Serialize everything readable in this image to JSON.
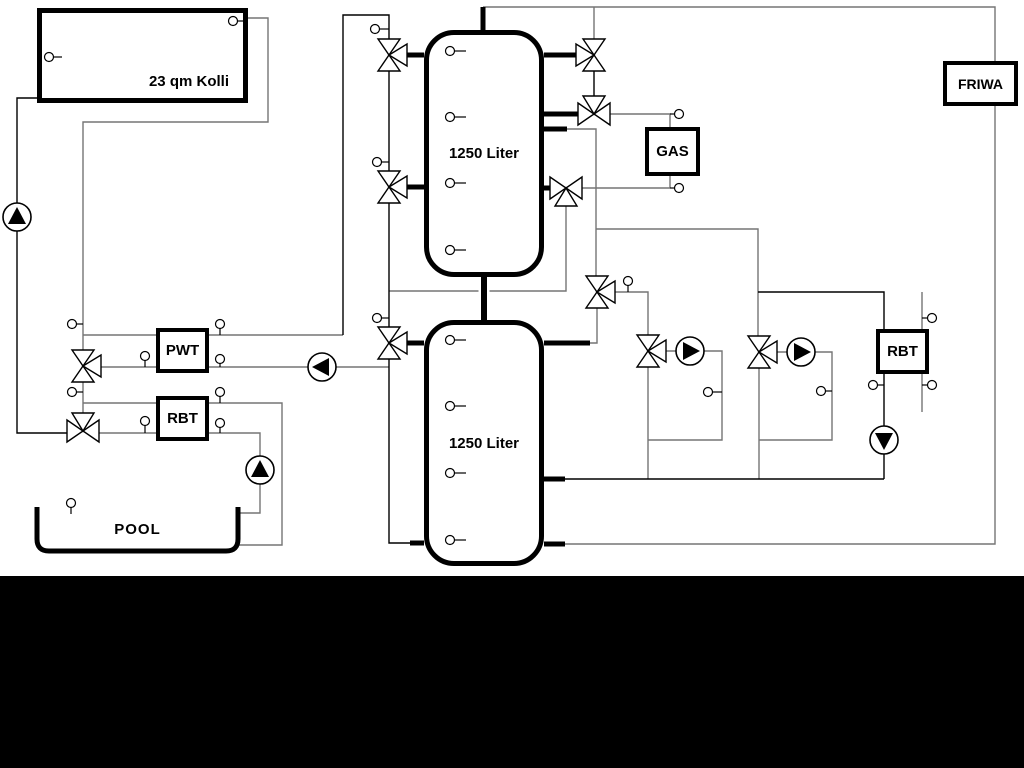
{
  "diagram": {
    "collector_label": "23 qm Kolli",
    "upper_tank_label": "1250 Liter",
    "lower_tank_label": "1250 Liter",
    "gas_label": "GAS",
    "friwa_label": "FRIWA",
    "pwt_label": "PWT",
    "rbt_left_label": "RBT",
    "rbt_right_label": "RBT",
    "pool_label": "POOL",
    "colors": {
      "pipe_gray": "#757575",
      "pipe_black": "#000000",
      "background": "#ffffff",
      "bottom_bar": "#000000"
    }
  }
}
